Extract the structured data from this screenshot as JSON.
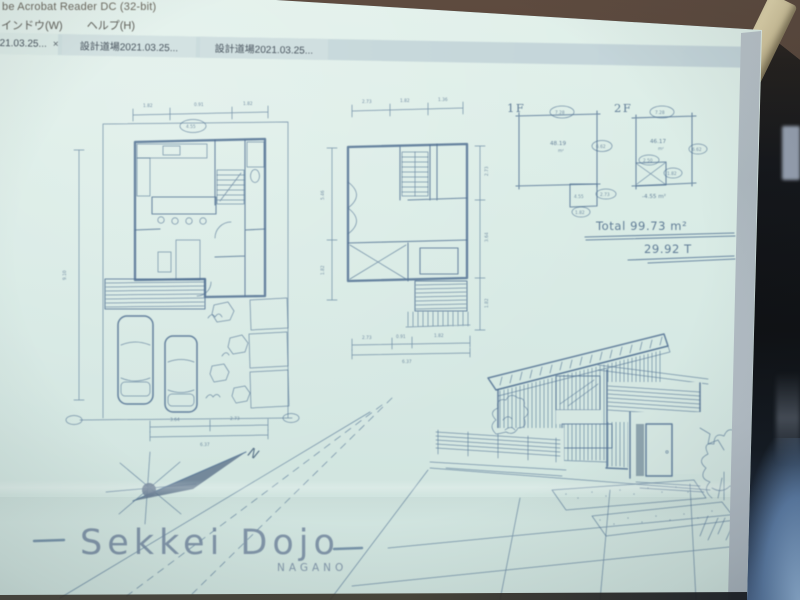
{
  "window": {
    "title": "be Acrobat Reader DC (32-bit)"
  },
  "menu": {
    "items": [
      {
        "label": "インドウ(W)"
      },
      {
        "label": "ヘルプ(H)"
      }
    ]
  },
  "tabs": [
    {
      "label": "021.03.25...",
      "close_label": "×",
      "active": true
    },
    {
      "label": "設計道場2021.03.25...",
      "active": false
    },
    {
      "label": "設計道場2021.03.25...",
      "active": false
    }
  ],
  "drawing": {
    "plan1f": {
      "dim_top_1": "1.82",
      "dim_top_2": "0.91",
      "dim_top_3": "1.82",
      "dim_top_bubble": "4.55",
      "dim_left": "9.10",
      "dim_bottom_1": "3.64",
      "dim_bottom_2": "2.73",
      "dim_bottom_total": "6.37"
    },
    "plan2f": {
      "dim_top_1": "2.73",
      "dim_top_2": "1.82",
      "dim_top_3": "1.36",
      "dim_left_1": "5.46",
      "dim_left_2": "1.82",
      "dim_right_1": "2.73",
      "dim_right_2": "3.64",
      "dim_right_3": "1.82",
      "dim_bottom_1": "2.73",
      "dim_bottom_2": "0.91",
      "dim_bottom_3": "1.82",
      "dim_bottom_total": "6.37"
    },
    "areas": {
      "f1_label": "1F",
      "f2_label": "2F",
      "f1_area": "48.19",
      "f1_area_unit": "m²",
      "f1_annex": "4.55",
      "f2_area": "46.17",
      "f2_area_unit": "m²",
      "f2_minus": "-4.55 m²",
      "f1_dim_top": "7.28",
      "f1_dim_right": "6.62",
      "f1_annex_dim_right": "2.73",
      "f1_annex_dim_bottom": "1.82",
      "f2_dim_top": "7.28",
      "f2_dim_right": "6.62",
      "f2_void_dim_1": "2.50",
      "f2_void_dim_2": "1.82",
      "total_line": "Total 99.73 m²",
      "tsubo_line": "29.92 T"
    },
    "compass": {
      "north": "N"
    },
    "signature": {
      "name": "Sekkei Dojo",
      "sub": "NAGANO"
    }
  },
  "colors": {
    "ink": "#517092",
    "screen": "#d6e8e3",
    "tab_band": "#c9dadb",
    "wall_brown": "#524036",
    "blue_glow": "#7fa0c8"
  }
}
